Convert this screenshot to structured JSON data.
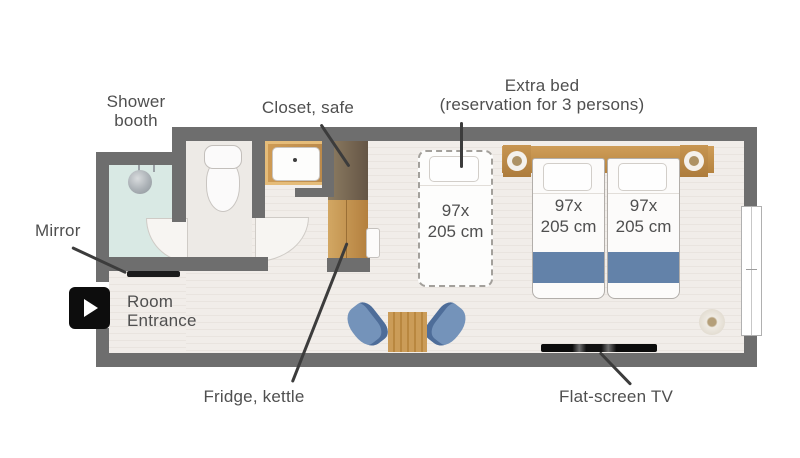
{
  "diagram": {
    "type": "hotel-room-floor-plan",
    "labels": {
      "shower_booth": {
        "line1": "Shower",
        "line2": "booth"
      },
      "closet_safe": {
        "text": "Closet, safe"
      },
      "extra_bed": {
        "line1": "Extra bed",
        "line2": "(reservation for 3 persons)"
      },
      "mirror": {
        "text": "Mirror"
      },
      "room_entrance": {
        "line1": "Room",
        "line2": "Entrance"
      },
      "fridge_kettle": {
        "text": "Fridge, kettle"
      },
      "flat_screen_tv": {
        "text": "Flat-screen TV"
      }
    },
    "bed_size": {
      "line1": "97x",
      "line2": "205 cm"
    },
    "icons": {
      "play": "play-icon"
    },
    "colors": {
      "wall": "#6e6e6e",
      "floor": "#f1ede9",
      "floor_stripe": "#e9e4df",
      "shower_floor": "#d9e9e4",
      "toilet_floor": "#edeae6",
      "wood": "#c49455",
      "closet_brown": "#77654f",
      "blanket_blue": "#6382a9",
      "chair_blue": "#7493ba",
      "label_text": "#4f4f4f",
      "pointer_line": "#3c3c3c",
      "tv_black": "#0b0b0b",
      "play_button": "#0d0d0d"
    }
  }
}
